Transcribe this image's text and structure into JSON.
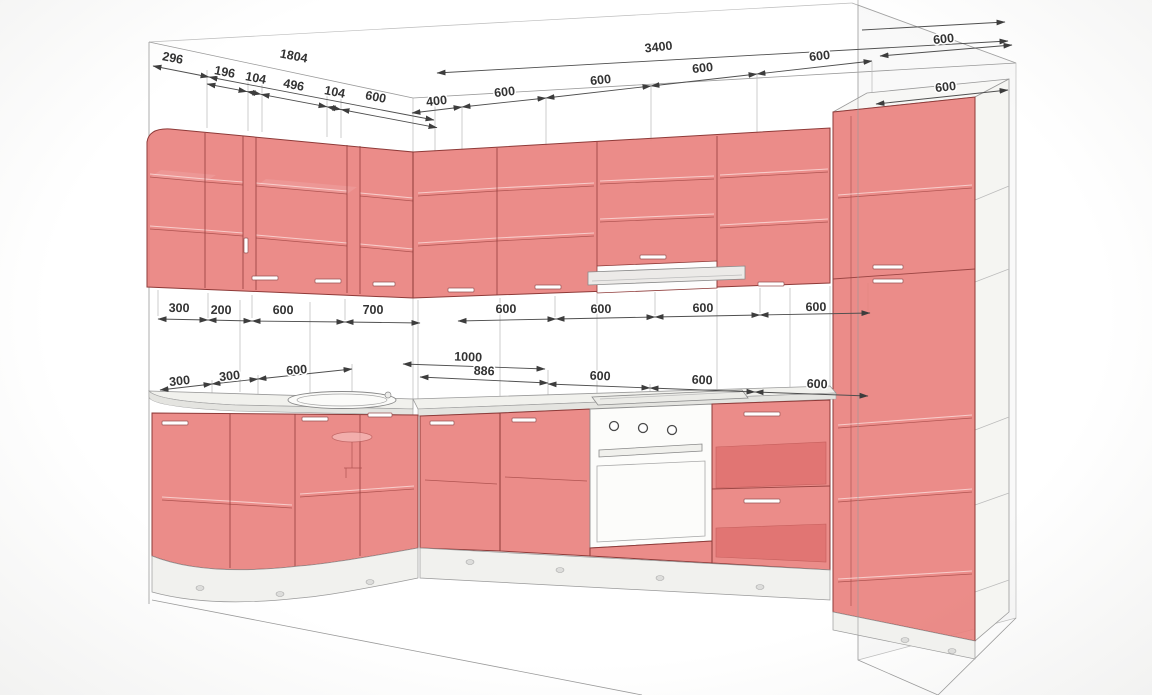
{
  "drawing": {
    "title": "kitchen-cabinet-3d-dimension-drawing",
    "units": "mm",
    "colors": {
      "cabinet_front": "#e97f7c",
      "cabinet_outline": "#8e3a38",
      "shelf_highlight": "#f8d3d1",
      "wireframe": "#9a9a9a",
      "dimension_line": "#4f4f4f",
      "dimension_text": "#333333",
      "countertop": "#f1f1ed",
      "appliance": "#fcfcfa",
      "background": "#ffffff"
    },
    "dimensions": {
      "ceiling_left": {
        "end_cap": "296",
        "overall": "1804",
        "segments": [
          "196",
          "104",
          "496",
          "104",
          "600"
        ]
      },
      "ceiling_back": {
        "overall": "3400",
        "segments": [
          "400",
          "600",
          "600",
          "600",
          "600"
        ]
      },
      "right_returns": [
        "600",
        "600"
      ],
      "wall_cabinet_row": {
        "left": [
          "300",
          "200",
          "600",
          "700"
        ],
        "back": [
          "600",
          "600",
          "600",
          "600"
        ]
      },
      "base_row": {
        "left": [
          "300",
          "300",
          "600"
        ],
        "back_overall": "1000",
        "back_first": "886",
        "back": [
          "600",
          "600",
          "600"
        ]
      }
    }
  }
}
